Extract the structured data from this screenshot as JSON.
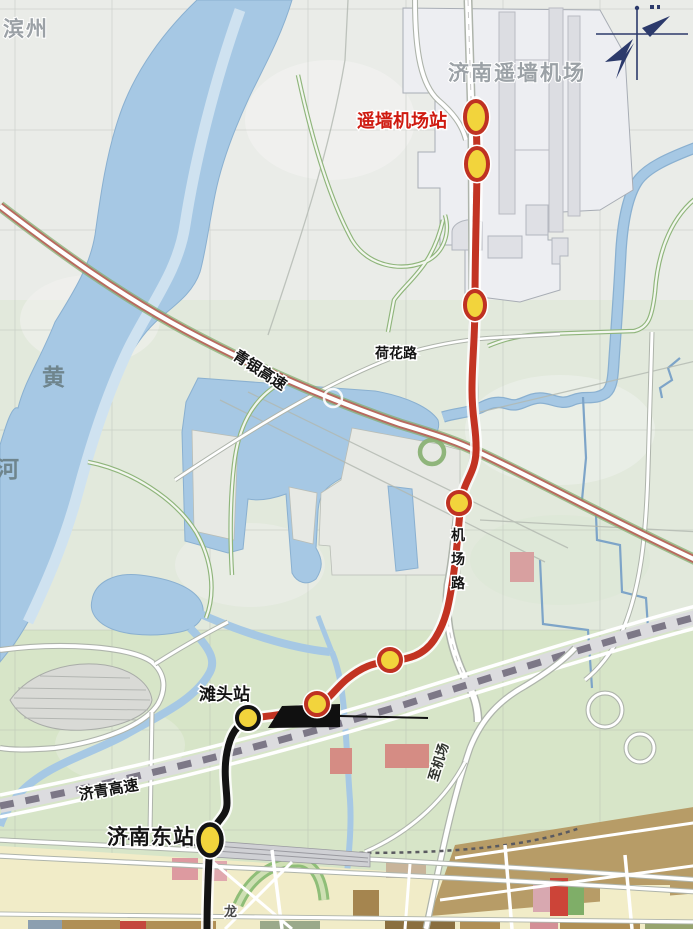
{
  "map": {
    "title": "济南遥墙机场轨道交通线路示意图",
    "region_labels": {
      "binzhou": "滨州",
      "airport_name": "济南遥墙机场",
      "yellow_river_upper": "黄",
      "yellow_river_lower": "河",
      "partial_place": "龙"
    },
    "stations": {
      "airport_station": "遥墙机场站",
      "tantou": "滩头站",
      "jinan_east": "济南东站"
    },
    "roads": {
      "qingyin_expressway": "青银高速",
      "hehua_road": "荷花路",
      "jichang_road": "机场路",
      "jiqing_expressway": "济青高速",
      "to_airport": "至机场"
    },
    "colors": {
      "metro_red": "#c23322",
      "metro_black": "#131313",
      "station_fill": "#f2d43c",
      "station_ring_red": "#bf3222",
      "station_ring_black": "#131313",
      "label_red": "#cf1a10",
      "label_gray": "#9ba1a6",
      "water": "#a6c8e4",
      "water_channel": "#cfe2f0",
      "expressway_red": "#b86a5e",
      "railway_dash": "#7d7887",
      "urban_yellow": "#f1ecc8",
      "land_north": "#eaece8",
      "land_mid": "#e2e9dc",
      "land_south": "#d7e5c8",
      "tan_block": "#b79c67",
      "compass_navy": "#2c3a6b"
    }
  }
}
